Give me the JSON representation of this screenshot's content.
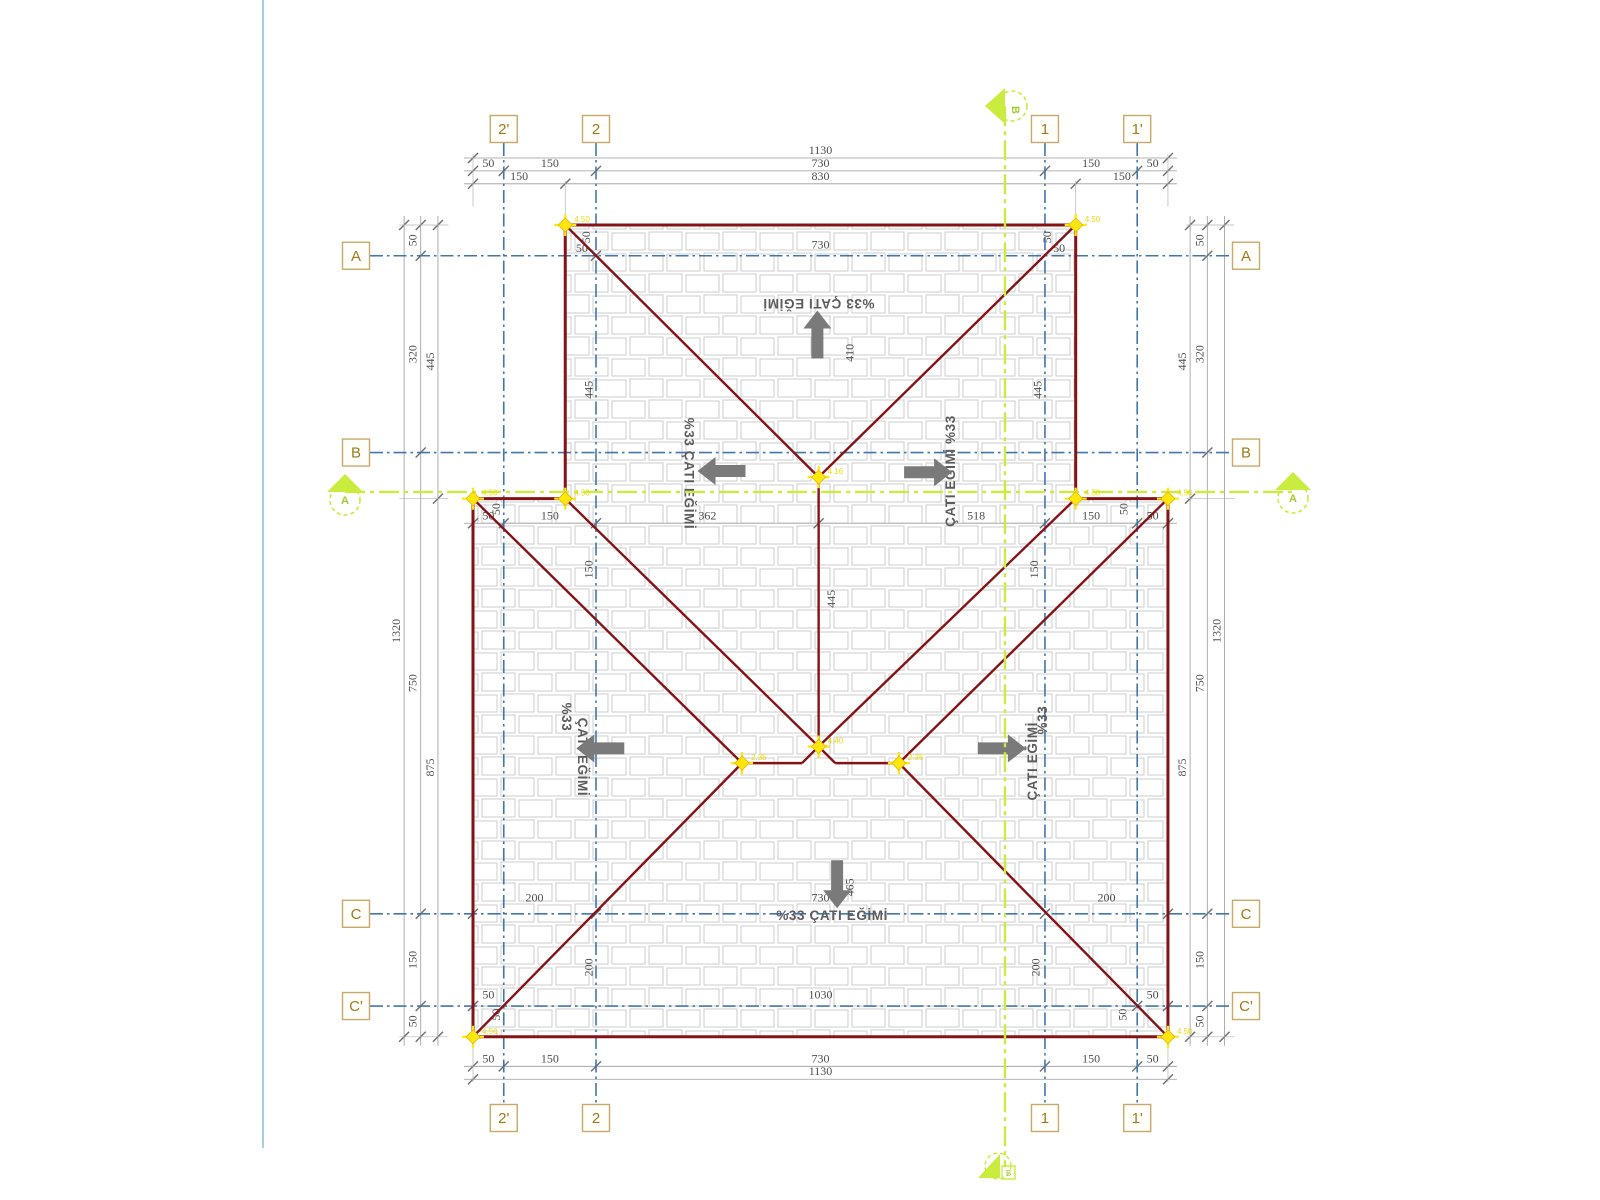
{
  "drawing": {
    "units_note": "cm",
    "colors": {
      "roof_line": "#851316",
      "grid_blue": "#4077ad",
      "section_green": "#c9ec3e",
      "marker_yellow": "#ffe60c",
      "dim_line": "#9a9a9a",
      "dim_text": "#4d4d4d",
      "slope_text": "#5c5c5c",
      "arrow_gray": "#7a7a7a",
      "box_border": "#c8a96b",
      "box_text": "#9c7a20",
      "tile_stroke": "#cccccc",
      "page_border": "#aacde6"
    },
    "grid_cols": [
      {
        "label": "2'",
        "x": 50
      },
      {
        "label": "2",
        "x": 200
      },
      {
        "label": "1",
        "x": 930
      },
      {
        "label": "1'",
        "x": 1080
      }
    ],
    "grid_rows": [
      {
        "label": "A",
        "y": 50
      },
      {
        "label": "B",
        "y": 370
      },
      {
        "label": "C",
        "y": 1120
      },
      {
        "label": "C'",
        "y": 1270
      }
    ],
    "roof_outline": [
      [
        150,
        0
      ],
      [
        980,
        0
      ],
      [
        980,
        445
      ],
      [
        1130,
        445
      ],
      [
        1130,
        1320
      ],
      [
        0,
        1320
      ],
      [
        0,
        445
      ],
      [
        150,
        445
      ]
    ],
    "roof_lines": [
      [
        150,
        0,
        562,
        410
      ],
      [
        980,
        0,
        562,
        410
      ],
      [
        562,
        410,
        562,
        848
      ],
      [
        150,
        445,
        562,
        848
      ],
      [
        980,
        445,
        562,
        848
      ],
      [
        562,
        848,
        535,
        875
      ],
      [
        562,
        848,
        589,
        875
      ],
      [
        437.5,
        875,
        535,
        875
      ],
      [
        589,
        875,
        692.5,
        875
      ],
      [
        0,
        445,
        437.5,
        875
      ],
      [
        0,
        1320,
        437.5,
        875
      ],
      [
        1130,
        445,
        692.5,
        875
      ],
      [
        1130,
        1320,
        692.5,
        875
      ]
    ],
    "corner_markers": [
      {
        "x": 150,
        "y": 0,
        "label": "4.50"
      },
      {
        "x": 980,
        "y": 0,
        "label": "4.50"
      },
      {
        "x": 0,
        "y": 445,
        "label": "4.50"
      },
      {
        "x": 150,
        "y": 445,
        "label": "4.50"
      },
      {
        "x": 980,
        "y": 445,
        "label": "4.50"
      },
      {
        "x": 1130,
        "y": 445,
        "label": "4.50"
      },
      {
        "x": 0,
        "y": 1320,
        "label": "4.50"
      },
      {
        "x": 1130,
        "y": 1320,
        "label": "4.50"
      },
      {
        "x": 562,
        "y": 410,
        "label": "4.16"
      },
      {
        "x": 562,
        "y": 848,
        "label": "4.40"
      },
      {
        "x": 437.5,
        "y": 875,
        "label": "2.35"
      },
      {
        "x": 692.5,
        "y": 875,
        "label": "2.35"
      }
    ],
    "section_lines": {
      "horizontal": {
        "y": 434,
        "x1": -208,
        "x2": 1333,
        "label": "A"
      },
      "vertical": {
        "x": 865,
        "y1": -193,
        "y2": 1532,
        "label": "B"
      }
    },
    "dim_rows": [
      {
        "y": -109,
        "ticks": [
          0,
          1130
        ],
        "labels": [
          {
            "t": "1130",
            "at": 565
          }
        ]
      },
      {
        "y": -88,
        "ticks": [
          0,
          50,
          200,
          930,
          1080,
          1130
        ],
        "labels": [
          {
            "t": "50",
            "at": 25
          },
          {
            "t": "150",
            "at": 125
          },
          {
            "t": "730",
            "at": 565
          },
          {
            "t": "150",
            "at": 1005
          },
          {
            "t": "50",
            "at": 1105
          }
        ]
      },
      {
        "y": -67,
        "ticks": [
          0,
          150,
          980,
          1130
        ],
        "labels": [
          {
            "t": "150",
            "at": 75
          },
          {
            "t": "830",
            "at": 565
          },
          {
            "t": "150",
            "at": 1055
          }
        ]
      },
      {
        "y": 485,
        "ticks": [
          0,
          50,
          200,
          562,
          930,
          1080,
          1130
        ],
        "labels": [
          {
            "t": "50",
            "at": 25
          },
          {
            "t": "150",
            "at": 125
          },
          {
            "t": "362",
            "at": 381
          },
          {
            "t": "518",
            "at": 818
          },
          {
            "t": "150",
            "at": 1005
          },
          {
            "t": "50",
            "at": 1105
          }
        ]
      },
      {
        "y": 1368,
        "ticks": [
          0,
          50,
          200,
          930,
          1080,
          1130
        ],
        "labels": [
          {
            "t": "50",
            "at": 25
          },
          {
            "t": "150",
            "at": 125
          },
          {
            "t": "730",
            "at": 565
          },
          {
            "t": "150",
            "at": 1005
          },
          {
            "t": "50",
            "at": 1105
          }
        ]
      },
      {
        "y": 1389,
        "ticks": [
          0,
          1130
        ],
        "labels": [
          {
            "t": "1130",
            "at": 565
          }
        ]
      }
    ],
    "dim_cols": [
      {
        "x": -112,
        "ticks": [
          0,
          1320
        ],
        "labels": [
          {
            "t": "1320",
            "at": 660
          }
        ]
      },
      {
        "x": -85,
        "ticks": [
          0,
          50,
          370,
          1120,
          1270,
          1320
        ],
        "labels": [
          {
            "t": "50",
            "at": 25
          },
          {
            "t": "320",
            "at": 210
          },
          {
            "t": "750",
            "at": 745
          },
          {
            "t": "150",
            "at": 1195
          },
          {
            "t": "50",
            "at": 1295
          }
        ]
      },
      {
        "x": -57,
        "ticks": [
          0,
          445,
          1320
        ],
        "labels": [
          {
            "t": "445",
            "at": 222
          },
          {
            "t": "875",
            "at": 882
          }
        ]
      },
      {
        "x": 1166,
        "ticks": [
          0,
          445,
          1320
        ],
        "labels": [
          {
            "t": "445",
            "at": 222
          },
          {
            "t": "875",
            "at": 882
          }
        ]
      },
      {
        "x": 1194,
        "ticks": [
          0,
          50,
          370,
          1120,
          1270,
          1320
        ],
        "labels": [
          {
            "t": "50",
            "at": 25
          },
          {
            "t": "320",
            "at": 210
          },
          {
            "t": "750",
            "at": 745
          },
          {
            "t": "150",
            "at": 1195
          },
          {
            "t": "50",
            "at": 1295
          }
        ]
      },
      {
        "x": 1222,
        "ticks": [
          0,
          1320
        ],
        "labels": [
          {
            "t": "1320",
            "at": 660
          }
        ]
      }
    ],
    "inline_dims": [
      {
        "t": "730",
        "x": 565,
        "y": 38,
        "rot": 0
      },
      {
        "t": "50",
        "x": 177,
        "y": 44,
        "rot": 0
      },
      {
        "t": "50",
        "x": 190,
        "y": 20,
        "rot": -90
      },
      {
        "t": "50",
        "x": 953,
        "y": 44,
        "rot": 0
      },
      {
        "t": "50",
        "x": 940,
        "y": 20,
        "rot": -90
      },
      {
        "t": "410",
        "x": 619,
        "y": 208,
        "rot": -90
      },
      {
        "t": "445",
        "x": 194,
        "y": 268,
        "rot": -90
      },
      {
        "t": "445",
        "x": 924,
        "y": 268,
        "rot": -90
      },
      {
        "t": "50",
        "x": 44,
        "y": 462,
        "rot": -90
      },
      {
        "t": "50",
        "x": 1064,
        "y": 462,
        "rot": -90
      },
      {
        "t": "150",
        "x": 194,
        "y": 560,
        "rot": -90
      },
      {
        "t": "150",
        "x": 919,
        "y": 560,
        "rot": -90
      },
      {
        "t": "445",
        "x": 589,
        "y": 608,
        "rot": -90
      },
      {
        "t": "465",
        "x": 619,
        "y": 1077,
        "rot": -90
      },
      {
        "t": "730",
        "x": 565,
        "y": 1100,
        "rot": 0
      },
      {
        "t": "200",
        "x": 100,
        "y": 1100,
        "rot": 0
      },
      {
        "t": "200",
        "x": 1030,
        "y": 1100,
        "rot": 0
      },
      {
        "t": "200",
        "x": 194,
        "y": 1207,
        "rot": -90
      },
      {
        "t": "200",
        "x": 921,
        "y": 1207,
        "rot": -90
      },
      {
        "t": "1030",
        "x": 565,
        "y": 1258,
        "rot": 0
      },
      {
        "t": "50",
        "x": 25,
        "y": 1258,
        "rot": 0
      },
      {
        "t": "50",
        "x": 1105,
        "y": 1258,
        "rot": 0
      },
      {
        "t": "50",
        "x": 44,
        "y": 1284,
        "rot": -90
      },
      {
        "t": "50",
        "x": 1063,
        "y": 1284,
        "rot": -90
      }
    ],
    "cross_ticks": [
      {
        "x": 200,
        "y": 50
      },
      {
        "x": 930,
        "y": 50
      },
      {
        "x": 0,
        "y": 1120
      },
      {
        "x": 200,
        "y": 1120
      },
      {
        "x": 930,
        "y": 1120
      },
      {
        "x": 1130,
        "y": 1120
      },
      {
        "x": 0,
        "y": 1270
      },
      {
        "x": 50,
        "y": 1270
      },
      {
        "x": 1080,
        "y": 1270
      },
      {
        "x": 1130,
        "y": 1270
      }
    ],
    "slope_labels": [
      {
        "t": "%33 ÇATI EĞİMİ",
        "x": 562,
        "y": 120,
        "rot": 180
      },
      {
        "t": "%33 ÇATI EĞİMİ",
        "x": 344,
        "y": 404,
        "rot": 90
      },
      {
        "t": "ÇATI EĞİMİ %33",
        "x": 784,
        "y": 400,
        "rot": -90
      },
      {
        "t": "%33",
        "x": 145,
        "y": 800,
        "rot": 90
      },
      {
        "t": "ÇATI EĞİMİ",
        "x": 171,
        "y": 865,
        "rot": 90
      },
      {
        "t": "%33",
        "x": 933,
        "y": 805,
        "rot": -90
      },
      {
        "t": "ÇATI EĞİMİ",
        "x": 917,
        "y": 872,
        "rot": -90
      },
      {
        "t": "%33 ÇATI EĞİMİ",
        "x": 584,
        "y": 1130,
        "rot": 0
      }
    ],
    "arrows": [
      {
        "x": 560,
        "y": 178,
        "dir": "up"
      },
      {
        "x": 404,
        "y": 400,
        "dir": "left"
      },
      {
        "x": 740,
        "y": 402,
        "dir": "right"
      },
      {
        "x": 207,
        "y": 851,
        "dir": "left"
      },
      {
        "x": 860,
        "y": 851,
        "dir": "right"
      },
      {
        "x": 592,
        "y": 1072,
        "dir": "down"
      }
    ]
  }
}
